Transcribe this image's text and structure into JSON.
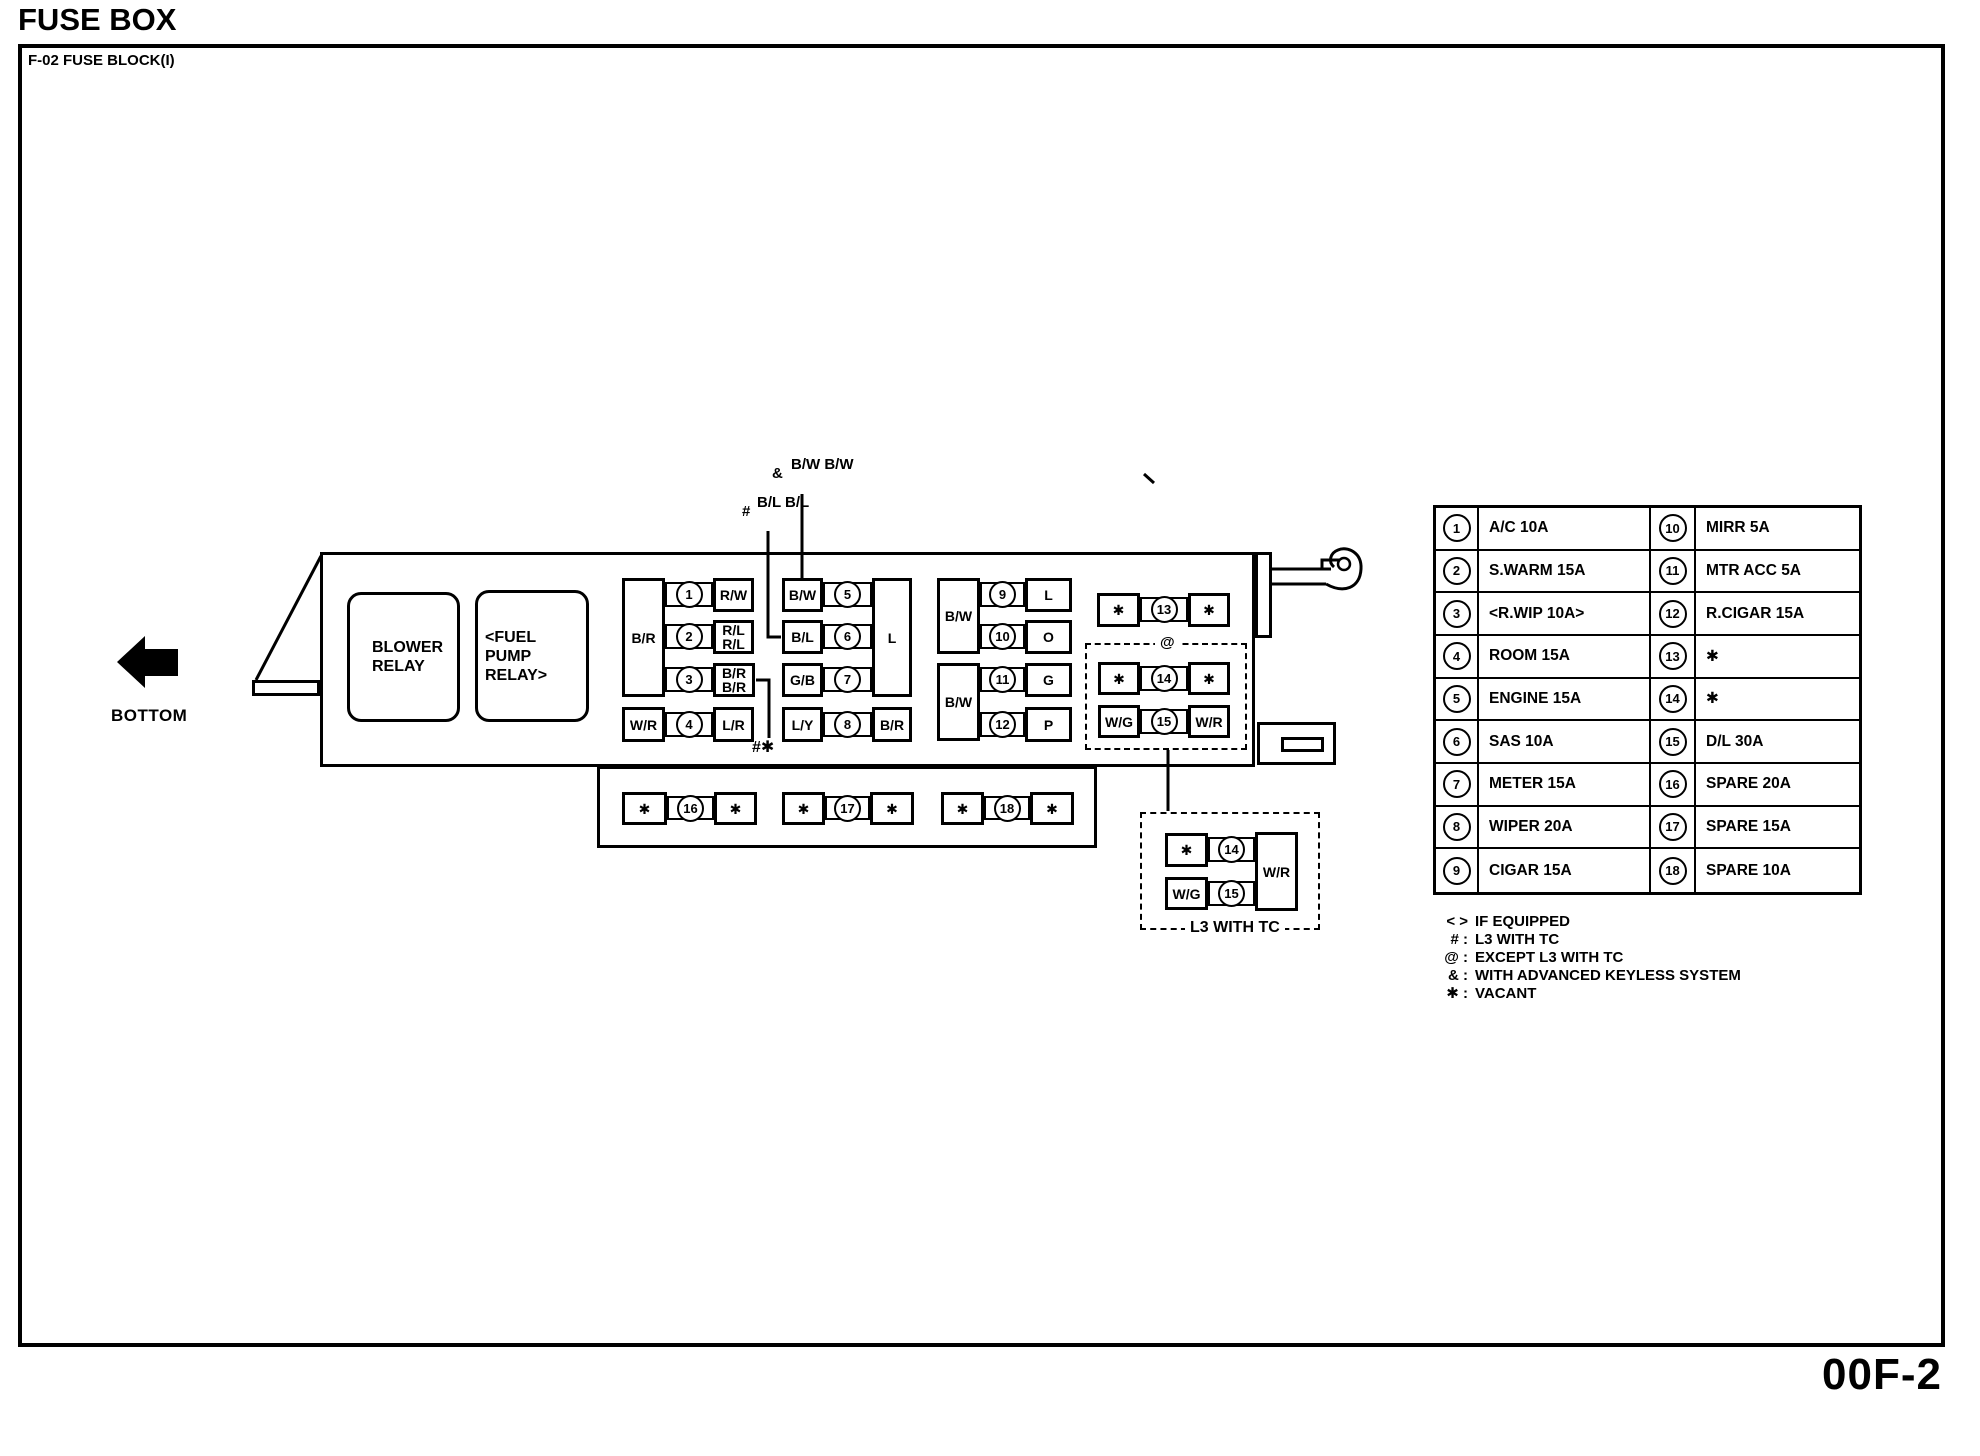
{
  "page": {
    "title": "FUSE BOX",
    "block_label": "F-02 FUSE BLOCK(I)",
    "page_number": "00F-2"
  },
  "diagram": {
    "arrow_label": "BOTTOM",
    "relay_blower": "BLOWER\nRELAY",
    "relay_fuel_pump": "<FUEL PUMP\nRELAY>",
    "ann_keyless_symbol": "&",
    "ann_keyless_wires": "B/W\nB/W",
    "ann_l3_symbol": "#",
    "ann_l3_wires": "B/L\nB/L",
    "ann_hash_star": "#✱",
    "ann_at": "@",
    "l3_box_label": "L3 WITH TC",
    "tall_boxes": {
      "g1": "B/R",
      "g2": "L",
      "g3a": "B/W",
      "g3b": "B/W",
      "l3": "W/R"
    },
    "fuses": {
      "f1": {
        "n": "1",
        "r": "R/W"
      },
      "f2": {
        "n": "2",
        "r": "R/L\nR/L"
      },
      "f3": {
        "n": "3",
        "r": "B/R\nB/R"
      },
      "f4": {
        "n": "4",
        "l": "W/R",
        "r": "L/R"
      },
      "f5": {
        "n": "5",
        "l": "B/W"
      },
      "f6": {
        "n": "6",
        "l": "B/L"
      },
      "f7": {
        "n": "7",
        "l": "G/B"
      },
      "f8": {
        "n": "8",
        "l": "L/Y",
        "r": "B/R"
      },
      "f9": {
        "n": "9",
        "r": "L"
      },
      "f10": {
        "n": "10",
        "r": "O"
      },
      "f11": {
        "n": "11",
        "r": "G"
      },
      "f12": {
        "n": "12",
        "r": "P"
      },
      "f13": {
        "n": "13",
        "l": "✱",
        "r": "✱"
      },
      "f14": {
        "n": "14",
        "l": "✱",
        "r": "✱"
      },
      "f15": {
        "n": "15",
        "l": "W/G",
        "r": "W/R"
      },
      "f16": {
        "n": "16",
        "l": "✱",
        "r": "✱"
      },
      "f17": {
        "n": "17",
        "l": "✱",
        "r": "✱"
      },
      "f18": {
        "n": "18",
        "l": "✱",
        "r": "✱"
      },
      "l3_f14": {
        "n": "14",
        "l": "✱"
      },
      "l3_f15": {
        "n": "15",
        "l": "W/G"
      }
    }
  },
  "table": {
    "rows": [
      {
        "n1": "1",
        "t1": "A/C 10A",
        "n2": "10",
        "t2": "MIRR 5A"
      },
      {
        "n1": "2",
        "t1": "S.WARM 15A",
        "n2": "11",
        "t2": "MTR ACC 5A"
      },
      {
        "n1": "3",
        "t1": "<R.WIP 10A>",
        "n2": "12",
        "t2": "R.CIGAR 15A"
      },
      {
        "n1": "4",
        "t1": "ROOM 15A",
        "n2": "13",
        "t2": "✱"
      },
      {
        "n1": "5",
        "t1": "ENGINE 15A",
        "n2": "14",
        "t2": "✱"
      },
      {
        "n1": "6",
        "t1": "SAS 10A",
        "n2": "15",
        "t2": "D/L 30A"
      },
      {
        "n1": "7",
        "t1": "METER 15A",
        "n2": "16",
        "t2": "SPARE 20A"
      },
      {
        "n1": "8",
        "t1": "WIPER 20A",
        "n2": "17",
        "t2": "SPARE 15A"
      },
      {
        "n1": "9",
        "t1": "CIGAR 15A",
        "n2": "18",
        "t2": "SPARE 10A"
      }
    ]
  },
  "legend": {
    "items": [
      {
        "symbol": "< >",
        "text": "IF EQUIPPED"
      },
      {
        "symbol": "# :",
        "text": "L3 WITH TC"
      },
      {
        "symbol": "@ :",
        "text": "EXCEPT L3 WITH TC"
      },
      {
        "symbol": "& :",
        "text": "WITH ADVANCED KEYLESS SYSTEM"
      },
      {
        "symbol": "✱ :",
        "text": "VACANT"
      }
    ]
  }
}
